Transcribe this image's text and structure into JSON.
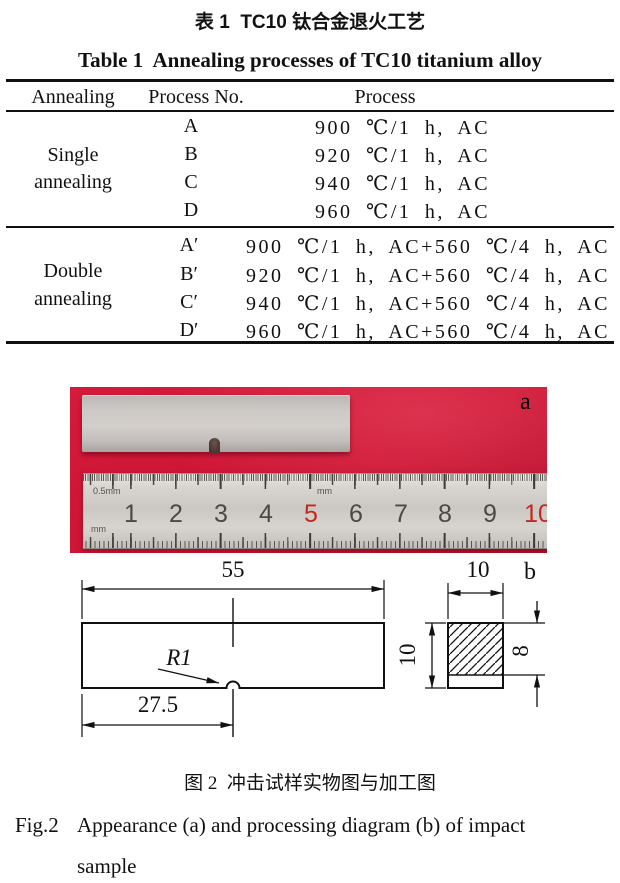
{
  "table": {
    "title_zh": "表 1  TC10 钛合金退火工艺",
    "title_en": "Table 1  Annealing processes of TC10 titanium alloy",
    "headers": [
      "Annealing",
      "Process No.",
      "Process"
    ],
    "groups": [
      {
        "name_line1": "Single",
        "name_line2": "annealing",
        "rows": [
          {
            "no": "A",
            "process": "900 ℃/1 h, AC"
          },
          {
            "no": "B",
            "process": "920 ℃/1 h, AC"
          },
          {
            "no": "C",
            "process": "940 ℃/1 h, AC"
          },
          {
            "no": "D",
            "process": "960 ℃/1 h, AC"
          }
        ]
      },
      {
        "name_line1": "Double",
        "name_line2": "annealing",
        "rows": [
          {
            "no": "A′",
            "process": "900 ℃/1 h, AC+560 ℃/4 h, AC"
          },
          {
            "no": "B′",
            "process": "920 ℃/1 h, AC+560 ℃/4 h, AC"
          },
          {
            "no": "C′",
            "process": "940 ℃/1 h, AC+560 ℃/4 h, AC"
          },
          {
            "no": "D′",
            "process": "960 ℃/1 h, AC+560 ℃/4 h, AC"
          }
        ]
      }
    ]
  },
  "figure": {
    "photo": {
      "label": "a",
      "ruler": {
        "numbers": [
          "1",
          "2",
          "3",
          "4",
          "5",
          "6",
          "7",
          "8",
          "9",
          "10"
        ],
        "scale_top": "0.5mm",
        "scale_mid": "mm",
        "scale_bottom": "mm"
      }
    },
    "diagram": {
      "label": "b",
      "length": "55",
      "notch_offset": "27.5",
      "notch_radius": "R1",
      "width_top": "10",
      "height_left": "10",
      "height_right": "8"
    },
    "caption_zh": "图 2  冲击试样实物图与加工图",
    "caption_en_prefix": "Fig.2",
    "caption_en_line1": "Appearance (a) and processing diagram (b) of impact",
    "caption_en_line2": "sample"
  },
  "colors": {
    "photo_red": "#cc1434",
    "ruler_red_digit": "#c4271f"
  }
}
